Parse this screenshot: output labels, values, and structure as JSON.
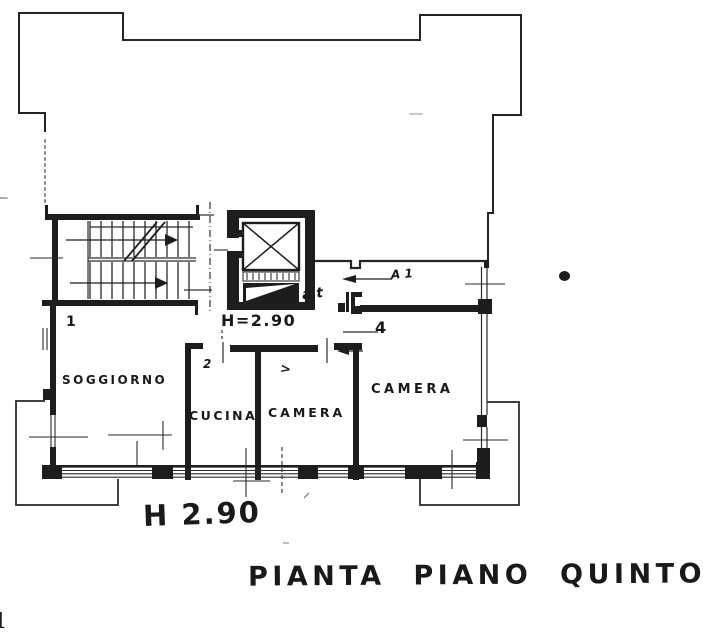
{
  "title": "PIANTA PIANO QUINTO",
  "rooms": [
    {
      "name": "SOGGIORNO"
    },
    {
      "name": "CUCINA"
    },
    {
      "name": "CAMERA"
    },
    {
      "name": "CAMERA"
    }
  ],
  "annotations": {
    "ceiling_height_hall": "H=2.90",
    "ceiling_height_main": "H 2.90",
    "loggia_mark": "A 1",
    "hall_handwriting": "a t",
    "room_number_soggiorno": "1",
    "door_mark_cucina": "2",
    "door_mark_camera_left": ">",
    "door_mark_camera_right": "4",
    "page_corner_mark": "1"
  },
  "colors": {
    "ink": "#1d1d1d",
    "paper": "#ffffff"
  }
}
